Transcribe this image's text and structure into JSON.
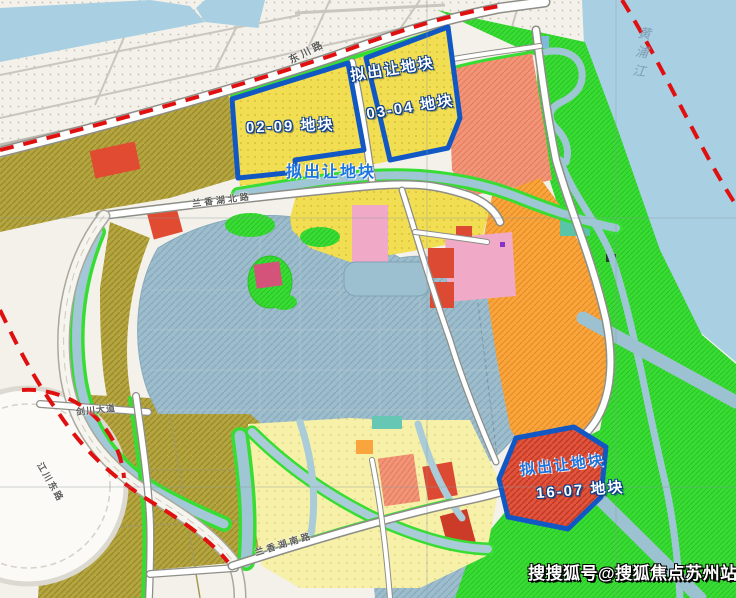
{
  "labels": {
    "proposed_top": "拟出让地块",
    "plot_03_04": "03-04 地块",
    "plot_02_09": "02-09 地块",
    "proposed_mid": "拟出让地块",
    "proposed_se": "拟出让地块",
    "plot_16_07": "16-07 地块"
  },
  "roads": {
    "dongchuan": "东川路",
    "lanxianghu_north": "兰香湖北路",
    "lanxianghu_south": "兰香湖南路",
    "jiangchuan_east": "江川东路",
    "jianchuan_avenue": "剑川大道"
  },
  "river": {
    "name": "黄浦江"
  },
  "watermark": {
    "text": "搜搜狐号@搜狐焦点苏州站"
  },
  "colors": {
    "highlight_parcel_outline": "#1158c4",
    "boundary_line": "#e01010",
    "proposed_text_blue": "#1b74e0",
    "residential_yellow": "#f2de52",
    "village_pale_yellow": "#f6f0a8",
    "campus_olive": "#b4a53f",
    "commercial_red": "#dd4a33",
    "mixed_salmon": "#f29478",
    "industrial_orange": "#f9a43c",
    "public_pink": "#f0a9c7",
    "green_space": "#38dd33",
    "river_water": "#a8cfe2",
    "lake_water": "#9dbdcd"
  }
}
